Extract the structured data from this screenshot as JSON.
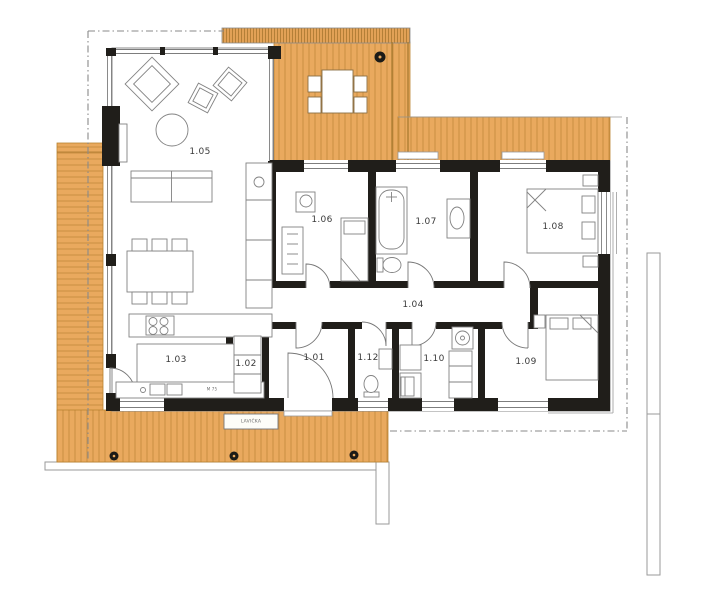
{
  "page": {
    "description": "Single-storey house floor plan with wrap-around wooden terraces",
    "background": "#ffffff"
  },
  "colors": {
    "deck": "#e9a95e",
    "deck_line": "#c1873a",
    "wall": "#201e1a",
    "outline": "#8a8a8a",
    "furniture_line": "#828282",
    "label_text": "#3a3a3a"
  },
  "rooms": [
    {
      "id": "1.01",
      "name": "entry-hall",
      "x": 314,
      "y": 358
    },
    {
      "id": "1.02",
      "name": "pantry",
      "x": 246,
      "y": 364
    },
    {
      "id": "1.03",
      "name": "kitchen",
      "x": 176,
      "y": 360
    },
    {
      "id": "1.04",
      "name": "corridor",
      "x": 413,
      "y": 305
    },
    {
      "id": "1.05",
      "name": "living-room",
      "x": 200,
      "y": 152
    },
    {
      "id": "1.06",
      "name": "bedroom-small",
      "x": 322,
      "y": 220
    },
    {
      "id": "1.07",
      "name": "bathroom",
      "x": 426,
      "y": 222
    },
    {
      "id": "1.08",
      "name": "bedroom-main",
      "x": 553,
      "y": 227
    },
    {
      "id": "1.09",
      "name": "bedroom-south",
      "x": 526,
      "y": 362
    },
    {
      "id": "1.10",
      "name": "technical-room",
      "x": 434,
      "y": 359
    },
    {
      "id": "1.12",
      "name": "wc",
      "x": 368,
      "y": 358
    }
  ],
  "annotations": [
    {
      "id": "bench",
      "text": "LAVIČKA",
      "x": 251,
      "y": 421.5,
      "size": 4.5
    },
    {
      "id": "door-note",
      "text": "M 75",
      "x": 212,
      "y": 389,
      "size": 4
    }
  ]
}
